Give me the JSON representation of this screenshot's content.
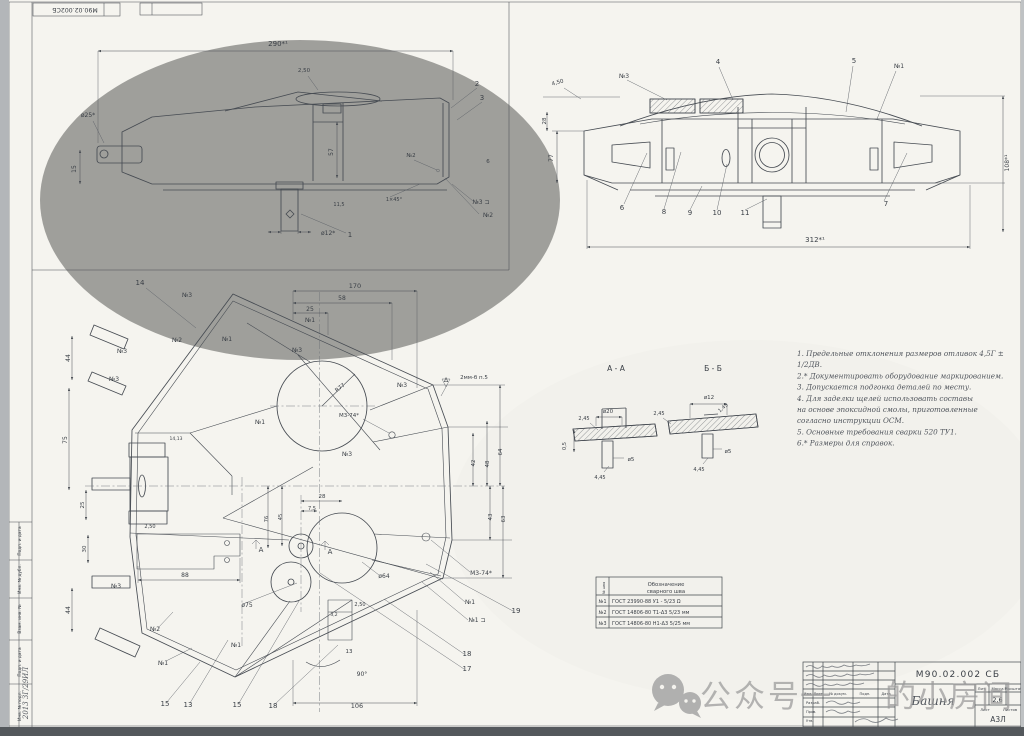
{
  "stamp_top": {
    "doc_number_mirrored": "М90.02.002СБ"
  },
  "watermark": {
    "icon": "wechat-icon",
    "text_prefix": "公众号",
    "text_hidden": "一",
    "text_suffix": "的小房间"
  },
  "notes": {
    "lines": [
      "1. Предельные отклонения размеров отливок 4,5Г ±",
      "    1/2ДВ.",
      "2.* Документировать оборудование маркированием.",
      "3. Допускается подгонка деталей по месту.",
      "4. Для заделки щелей использовать составы",
      "    на основе эпоксидной смолы, приготовленные",
      "    согласно инструкции ОСМ.",
      "5. Основные требования сварки 520 ТУ1.",
      "6.* Размеры для справок."
    ]
  },
  "weld_table": {
    "num_header": "№ шва",
    "col_header_line1": "Обозначение",
    "col_header_line2": "сварного шва",
    "rows": [
      {
        "num": "№1",
        "designation": "ГОСТ 23990-88   У1 - 5/23  Ω"
      },
      {
        "num": "№2",
        "designation": "ГОСТ 14806-80   Т1-Δ3  5/23 мм"
      },
      {
        "num": "№3",
        "designation": "ГОСТ 14806-80   Н1-Δ3  5/25 мм"
      }
    ]
  },
  "title_block": {
    "doc_number": "М90.02.002 СБ",
    "name": "Башня",
    "mass": "2,6",
    "format_code": "А3Л",
    "lit_label": "Лит.",
    "mass_label": "Масса",
    "scale_label": "Масштаб",
    "sheet_label": "Лист",
    "sheets_label": "Листов",
    "copied_label": "Копировал",
    "format_label": "Формат А4",
    "header_labels": [
      {
        "t": "Изм.",
        "x": 808,
        "y": 695,
        "s": 3.6
      },
      {
        "t": "Лист",
        "x": 818,
        "y": 695,
        "s": 3.6
      },
      {
        "t": "№ докум.",
        "x": 838,
        "y": 695,
        "s": 3.6
      },
      {
        "t": "Подп.",
        "x": 865,
        "y": 695,
        "s": 3.6
      },
      {
        "t": "Дата",
        "x": 886,
        "y": 695,
        "s": 3.6
      },
      {
        "t": "Разраб.",
        "x": 806,
        "y": 704,
        "s": 3.6,
        "a": "s"
      },
      {
        "t": "Пров.",
        "x": 806,
        "y": 713,
        "s": 3.6,
        "a": "s"
      },
      {
        "t": "Утв.",
        "x": 806,
        "y": 722,
        "s": 3.6,
        "a": "s"
      }
    ]
  },
  "left_strip": {
    "labels": [
      {
        "t": "Подп. и дата",
        "x": 21,
        "y": 541,
        "r": -90,
        "s": 4.3
      },
      {
        "t": "Инв. № дубл.",
        "x": 21,
        "y": 579,
        "r": -90,
        "s": 4.3
      },
      {
        "t": "Взам. инв. №",
        "x": 21,
        "y": 619,
        "r": -90,
        "s": 4.3
      },
      {
        "t": "Подп. и дата",
        "x": 21,
        "y": 662,
        "r": -90,
        "s": 4.3
      },
      {
        "t": "Инв. № подл.",
        "x": 21,
        "y": 706,
        "r": -90,
        "s": 4.3
      },
      {
        "t": "2013 ЗГ/29ИЛ",
        "x": 28,
        "y": 693,
        "r": -90,
        "s": 7,
        "c": "hw"
      }
    ]
  },
  "side_view": {
    "labels": [
      {
        "t": "290*¹",
        "x": 278,
        "y": 46,
        "s": 7
      },
      {
        "t": "2,50",
        "x": 304,
        "y": 72,
        "s": 5.5
      },
      {
        "t": "2",
        "x": 477,
        "y": 86,
        "s": 7
      },
      {
        "t": "3",
        "x": 482,
        "y": 100,
        "s": 7
      },
      {
        "t": "ø25*",
        "x": 88,
        "y": 117,
        "s": 6
      },
      {
        "t": "15",
        "x": 76,
        "y": 169,
        "r": -90,
        "s": 6
      },
      {
        "t": "57",
        "x": 333,
        "y": 152,
        "r": -90,
        "s": 6
      },
      {
        "t": "11,5",
        "x": 339,
        "y": 206,
        "s": 5
      },
      {
        "t": "1×45°",
        "x": 394,
        "y": 201,
        "s": 5
      },
      {
        "t": "ø12*",
        "x": 321,
        "y": 235,
        "s": 6,
        "a": "s"
      },
      {
        "t": "1",
        "x": 350,
        "y": 237,
        "s": 7
      },
      {
        "t": "№2",
        "x": 411,
        "y": 157,
        "s": 5.5
      },
      {
        "t": "№3 ⊐",
        "x": 481,
        "y": 204,
        "s": 6
      },
      {
        "t": "№2",
        "x": 488,
        "y": 217,
        "s": 6
      },
      {
        "t": "6",
        "x": 488,
        "y": 163,
        "s": 5.5
      }
    ]
  },
  "front_view": {
    "labels": [
      {
        "t": "4,50",
        "x": 558,
        "y": 84,
        "s": 5.5,
        "r": -15
      },
      {
        "t": "№3",
        "x": 624,
        "y": 78,
        "s": 6
      },
      {
        "t": "4",
        "x": 718,
        "y": 64,
        "s": 7
      },
      {
        "t": "5",
        "x": 854,
        "y": 63,
        "s": 7
      },
      {
        "t": "№1",
        "x": 899,
        "y": 68,
        "s": 6
      },
      {
        "t": "28",
        "x": 546,
        "y": 121,
        "r": -90,
        "s": 5.5
      },
      {
        "t": "77",
        "x": 553,
        "y": 158,
        "r": -90,
        "s": 6
      },
      {
        "t": "108*¹",
        "x": 1009,
        "y": 163,
        "r": -90,
        "s": 6
      },
      {
        "t": "6",
        "x": 622,
        "y": 210,
        "s": 7
      },
      {
        "t": "8",
        "x": 664,
        "y": 214,
        "s": 7
      },
      {
        "t": "9",
        "x": 690,
        "y": 215,
        "s": 7
      },
      {
        "t": "10",
        "x": 717,
        "y": 215,
        "s": 7
      },
      {
        "t": "11",
        "x": 745,
        "y": 215,
        "s": 7
      },
      {
        "t": "7",
        "x": 886,
        "y": 206,
        "s": 7
      },
      {
        "t": "312*¹",
        "x": 815,
        "y": 242,
        "s": 7
      }
    ]
  },
  "plan_view": {
    "labels": [
      {
        "t": "14",
        "x": 140,
        "y": 285,
        "s": 7
      },
      {
        "t": "№3",
        "x": 187,
        "y": 297,
        "s": 6
      },
      {
        "t": "№2",
        "x": 177,
        "y": 342,
        "s": 6
      },
      {
        "t": "№3",
        "x": 122,
        "y": 353,
        "s": 6
      },
      {
        "t": "№3",
        "x": 114,
        "y": 381,
        "s": 6
      },
      {
        "t": "№1",
        "x": 227,
        "y": 341,
        "s": 6
      },
      {
        "t": "170",
        "x": 355,
        "y": 288,
        "s": 6.5
      },
      {
        "t": "58",
        "x": 342,
        "y": 300,
        "s": 6
      },
      {
        "t": "25",
        "x": 310,
        "y": 311,
        "s": 6
      },
      {
        "t": "№1",
        "x": 310,
        "y": 322,
        "s": 6
      },
      {
        "t": "№3",
        "x": 297,
        "y": 352,
        "s": 6
      },
      {
        "t": "№1",
        "x": 260,
        "y": 424,
        "s": 6
      },
      {
        "t": "№3",
        "x": 402,
        "y": 387,
        "s": 6
      },
      {
        "t": "Δ",
        "x": 446,
        "y": 382,
        "s": 6
      },
      {
        "t": "2мм-б  п.5",
        "x": 474,
        "y": 379,
        "s": 5.5
      },
      {
        "t": "R77",
        "x": 341,
        "y": 389,
        "r": -38,
        "s": 5.5
      },
      {
        "t": "М3-74*",
        "x": 349,
        "y": 417,
        "s": 5.5
      },
      {
        "t": "М3-74*",
        "x": 481,
        "y": 575,
        "s": 6
      },
      {
        "t": "14,13",
        "x": 176,
        "y": 440,
        "s": 4.5
      },
      {
        "t": "44",
        "x": 70,
        "y": 358,
        "r": -90,
        "s": 6
      },
      {
        "t": "75",
        "x": 67,
        "y": 440,
        "r": -90,
        "s": 6
      },
      {
        "t": "25",
        "x": 84,
        "y": 505,
        "r": -90,
        "s": 5.5
      },
      {
        "t": "30",
        "x": 86,
        "y": 549,
        "r": -90,
        "s": 5.5
      },
      {
        "t": "44",
        "x": 70,
        "y": 610,
        "r": -90,
        "s": 6
      },
      {
        "t": "2,50",
        "x": 150,
        "y": 528,
        "s": 5
      },
      {
        "t": "88",
        "x": 185,
        "y": 577,
        "s": 6
      },
      {
        "t": "ø75",
        "x": 247,
        "y": 607,
        "s": 6
      },
      {
        "t": "ø64",
        "x": 384,
        "y": 578,
        "s": 6
      },
      {
        "t": "28",
        "x": 322,
        "y": 498,
        "s": 5.5
      },
      {
        "t": "7,5",
        "x": 312,
        "y": 510,
        "s": 5
      },
      {
        "t": "76",
        "x": 268,
        "y": 519,
        "r": -90,
        "s": 5
      },
      {
        "t": "45",
        "x": 282,
        "y": 517,
        "r": -90,
        "s": 5
      },
      {
        "t": "А",
        "x": 261,
        "y": 552,
        "s": 7
      },
      {
        "t": "А",
        "x": 330,
        "y": 554,
        "s": 7
      },
      {
        "t": "2,50",
        "x": 360,
        "y": 606,
        "s": 5
      },
      {
        "t": "42",
        "x": 475,
        "y": 463,
        "r": -90,
        "s": 5.5
      },
      {
        "t": "48",
        "x": 489,
        "y": 464,
        "r": -90,
        "s": 5.5
      },
      {
        "t": "64",
        "x": 502,
        "y": 452,
        "r": -90,
        "s": 5.5
      },
      {
        "t": "43",
        "x": 492,
        "y": 517,
        "r": -90,
        "s": 5.5
      },
      {
        "t": "63",
        "x": 505,
        "y": 519,
        "r": -90,
        "s": 5.5
      },
      {
        "t": "№1",
        "x": 470,
        "y": 604,
        "s": 6
      },
      {
        "t": "№1 ⊐",
        "x": 477,
        "y": 622,
        "s": 6
      },
      {
        "t": "19",
        "x": 516,
        "y": 613,
        "s": 7
      },
      {
        "t": "18",
        "x": 467,
        "y": 656,
        "s": 7
      },
      {
        "t": "17",
        "x": 467,
        "y": 671,
        "s": 7
      },
      {
        "t": "№2",
        "x": 155,
        "y": 631,
        "s": 6
      },
      {
        "t": "№1",
        "x": 163,
        "y": 665,
        "s": 6
      },
      {
        "t": "№1",
        "x": 236,
        "y": 647,
        "s": 6
      },
      {
        "t": "№3",
        "x": 116,
        "y": 588,
        "s": 6
      },
      {
        "t": "№3",
        "x": 347,
        "y": 456,
        "s": 6
      },
      {
        "t": "3,2",
        "x": 334,
        "y": 616,
        "s": 4.5
      },
      {
        "t": "13",
        "x": 349,
        "y": 653,
        "s": 5.5
      },
      {
        "t": "90°",
        "x": 362,
        "y": 676,
        "s": 6
      },
      {
        "t": "15",
        "x": 165,
        "y": 706,
        "s": 7
      },
      {
        "t": "13",
        "x": 188,
        "y": 707,
        "s": 7
      },
      {
        "t": "15",
        "x": 237,
        "y": 707,
        "s": 7
      },
      {
        "t": "18",
        "x": 273,
        "y": 708,
        "s": 7
      },
      {
        "t": "106",
        "x": 357,
        "y": 708,
        "s": 6.5
      }
    ]
  },
  "sections": {
    "labels": [
      {
        "t": "А - А",
        "x": 616,
        "y": 371,
        "s": 7.5
      },
      {
        "t": "Б - Б",
        "x": 713,
        "y": 371,
        "s": 7.5
      },
      {
        "t": "ø20",
        "x": 608,
        "y": 413,
        "s": 5.5
      },
      {
        "t": "2,45",
        "x": 584,
        "y": 420,
        "s": 5
      },
      {
        "t": "ø5",
        "x": 631,
        "y": 461,
        "s": 5.5
      },
      {
        "t": "4,45",
        "x": 600,
        "y": 479,
        "s": 5
      },
      {
        "t": "0,5",
        "x": 566,
        "y": 446,
        "r": -90,
        "s": 5
      },
      {
        "t": "ø12",
        "x": 709,
        "y": 399,
        "s": 5.5
      },
      {
        "t": "2,45",
        "x": 659,
        "y": 415,
        "s": 5
      },
      {
        "t": "1,45",
        "x": 724,
        "y": 409,
        "r": -40,
        "s": 5
      },
      {
        "t": "ø5",
        "x": 728,
        "y": 453,
        "s": 5.5
      },
      {
        "t": "4,45",
        "x": 699,
        "y": 471,
        "s": 5
      }
    ]
  }
}
